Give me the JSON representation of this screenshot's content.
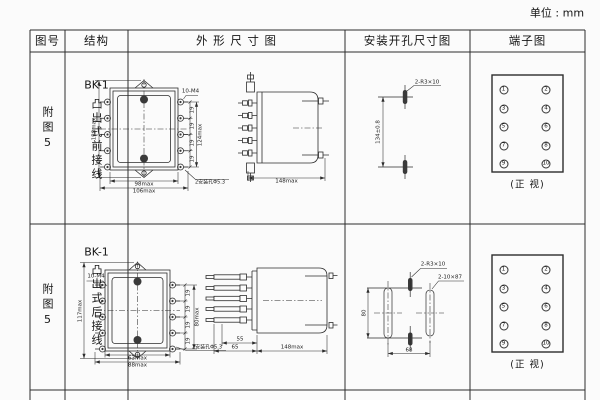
{
  "unit_label": "单位 : mm",
  "colors": {
    "ink": "#2d2d2d",
    "paper": "#fbfbfb"
  },
  "headers": {
    "fig_no": "图号",
    "structure": "结构",
    "outline": "外 形 尺 寸 图",
    "mounting": "安装开孔尺寸图",
    "terminal": "端子图"
  },
  "rows": [
    {
      "fig_no": "附图5",
      "model": "BK-1",
      "structure": "凸出式前接线",
      "outline_front": {
        "height": "138max",
        "terminal_span": "124max",
        "pitch": "19",
        "screws": "10-M4",
        "width_body": "98max",
        "width_overall": "106max",
        "holes_note": "2安装孔Φ5.3"
      },
      "outline_side": {
        "depth": "148max"
      },
      "mounting": {
        "hole_spacing": "134±0.8",
        "slots_note": "2-R3×10"
      },
      "terminal": {
        "col_left": [
          "1",
          "3",
          "5",
          "7",
          "9"
        ],
        "col_right": [
          "2",
          "4",
          "6",
          "8",
          "10"
        ],
        "caption": "(正 视)"
      }
    },
    {
      "fig_no": "附图5",
      "model": "BK-1",
      "structure": "凸出式后接线",
      "outline_front": {
        "height": "117max",
        "terminal_span": "80max",
        "pitch": "19",
        "screws": "10-M4",
        "width_body": "63max",
        "width_overall": "88max",
        "holes_note": "2安装孔Φ5.3"
      },
      "outline_side": {
        "stud_len": "55",
        "front_len": "65",
        "depth": "148max"
      },
      "mounting": {
        "slot_span": "80",
        "slot_pitch": "68",
        "slots_note": "2-R3×10",
        "cutouts_note": "2-10×87"
      },
      "terminal": {
        "col_left": [
          "1",
          "3",
          "5",
          "7",
          "9"
        ],
        "col_right": [
          "2",
          "4",
          "6",
          "8",
          "10"
        ],
        "caption": "(正 视)"
      }
    }
  ]
}
